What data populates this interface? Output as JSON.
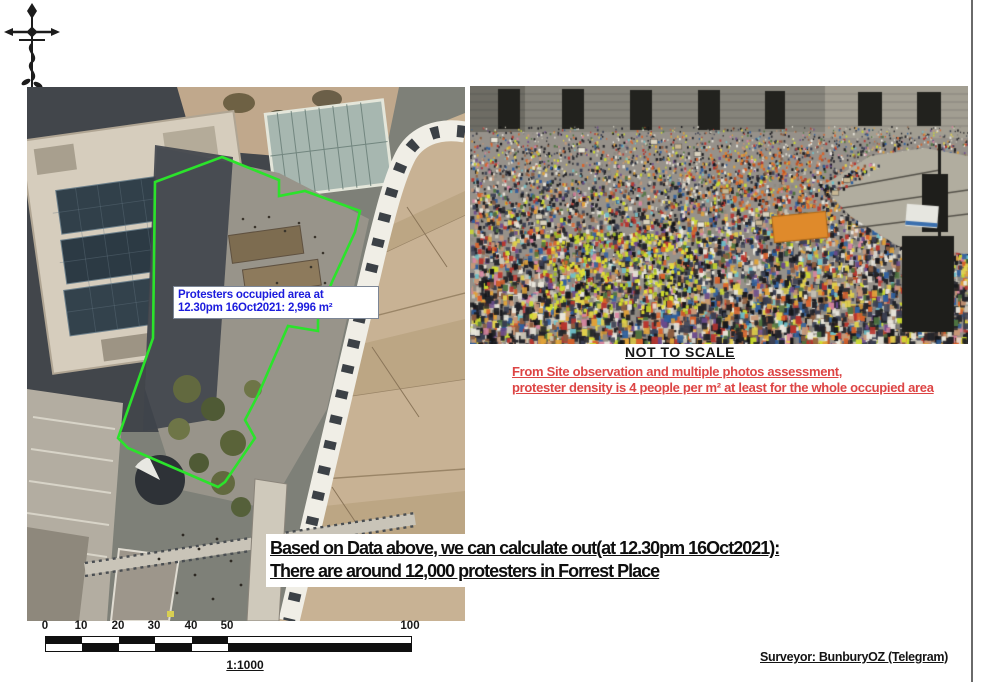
{
  "colors": {
    "polygon_green": "#2be32b",
    "label_blue": "#1c1cdd",
    "warning_red": "#dd4444"
  },
  "aerial_map": {
    "area_label": {
      "line1": "Protesters occupied area at",
      "line2": "12.30pm 16Oct2021: 2,996 m²"
    }
  },
  "crowd_photo": {
    "caption": "NOT TO SCALE",
    "banner_color": "#df8a2b",
    "palette": [
      {
        "c": "#23242a",
        "w": 16
      },
      {
        "c": "#3a3f52",
        "w": 8
      },
      {
        "c": "#15161a",
        "w": 8
      },
      {
        "c": "#e9e6dc",
        "w": 10
      },
      {
        "c": "#c9c4b6",
        "w": 6
      },
      {
        "c": "#8c8880",
        "w": 6
      },
      {
        "c": "#b8352e",
        "w": 5
      },
      {
        "c": "#d9622b",
        "w": 5
      },
      {
        "c": "#e0a33a",
        "w": 4
      },
      {
        "c": "#e3d24b",
        "w": 4
      },
      {
        "c": "#cddc2e",
        "w": 4
      },
      {
        "c": "#2e5f9e",
        "w": 5
      },
      {
        "c": "#6fc0c9",
        "w": 2
      },
      {
        "c": "#6a4a8c",
        "w": 3
      },
      {
        "c": "#c89878",
        "w": 6
      },
      {
        "c": "#8a5c40",
        "w": 4
      },
      {
        "c": "#d884a0",
        "w": 2
      },
      {
        "c": "#4f7440",
        "w": 3
      }
    ]
  },
  "density_note": {
    "line1": "From Site observation and multiple photos assessment,",
    "line2": "protester density is 4 people per m² at least for the whole occupied area"
  },
  "conclusion": {
    "line1": "Based on Data above, we can calculate out(at 12.30pm 16Oct2021):",
    "line2": "There are around 12,000 protesters in Forrest Place"
  },
  "scale_bar": {
    "ticks": [
      "0",
      "10",
      "20",
      "30",
      "40",
      "50",
      "100"
    ],
    "ratio": "1:1000"
  },
  "footer": {
    "surveyor": "Surveyor: BunburyOZ (Telegram)"
  }
}
